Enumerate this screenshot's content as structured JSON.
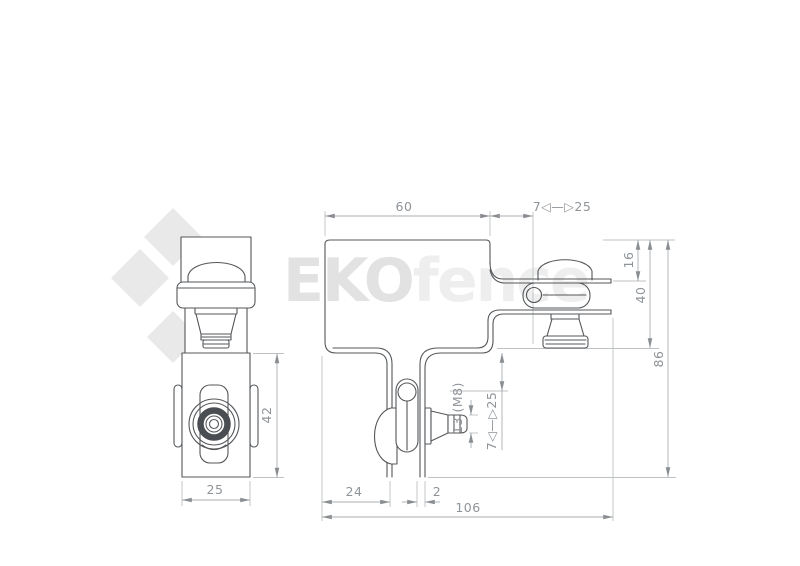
{
  "watermark": {
    "bold": "EKO",
    "light": "fence"
  },
  "logo": {
    "name": "eko-diamond-logo"
  },
  "colors": {
    "object_line": "#54575a",
    "dimension_line": "#a9adb0",
    "extension_line": "#bfc2c5",
    "dimension_text": "#8f9499",
    "watermark_bold": "#e2e2e2",
    "watermark_light": "#eeeeee",
    "logo_gray": "#e9e9e9",
    "background": "#ffffff"
  },
  "dims": {
    "top_width": "60",
    "top_range": "7◁—▷25",
    "offset_16": "16",
    "height_40": "40",
    "height_86": "86",
    "offset_24": "24",
    "thickness_2": "2",
    "width_106": "106",
    "nut": "13 (M8)",
    "side_range": "7◁—▷25",
    "front_width": "25",
    "front_height": "42"
  }
}
